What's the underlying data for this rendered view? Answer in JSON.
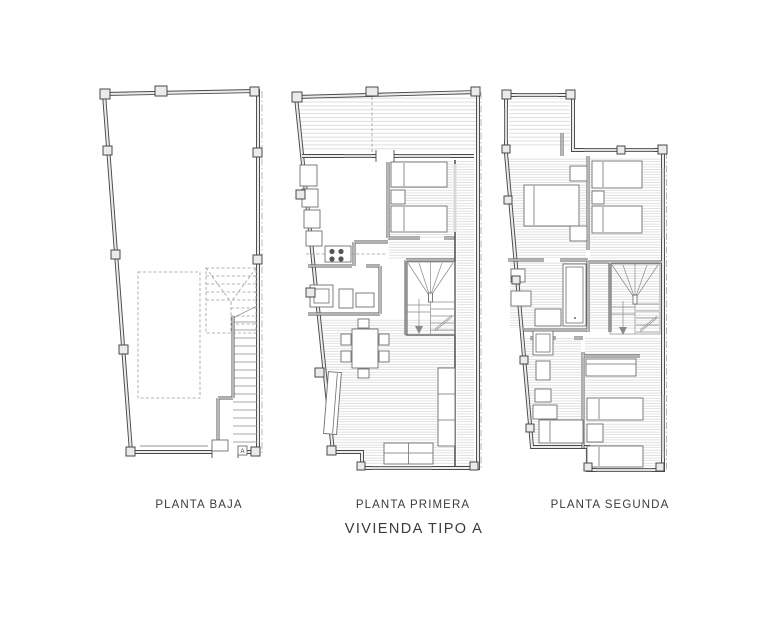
{
  "title": "VIVIENDA TIPO A",
  "plans": [
    {
      "id": "planta-baja",
      "label": "PLANTA BAJA"
    },
    {
      "id": "planta-primera",
      "label": "PLANTA PRIMERA"
    },
    {
      "id": "planta-segunda",
      "label": "PLANTA SEGUNDA"
    }
  ],
  "annotations": {
    "meter_box_label": "A"
  },
  "colors": {
    "background": "#ffffff",
    "wall-line": "#4a4a4a",
    "wall-fill": "#ebebeb",
    "partition-line": "#555555",
    "hatch-line": "#c9c9c9",
    "furniture-line": "#6f6f6f",
    "dashed-line": "#9b9b9b",
    "window-line": "#b9b9b9",
    "text": "#3b3b3b"
  }
}
